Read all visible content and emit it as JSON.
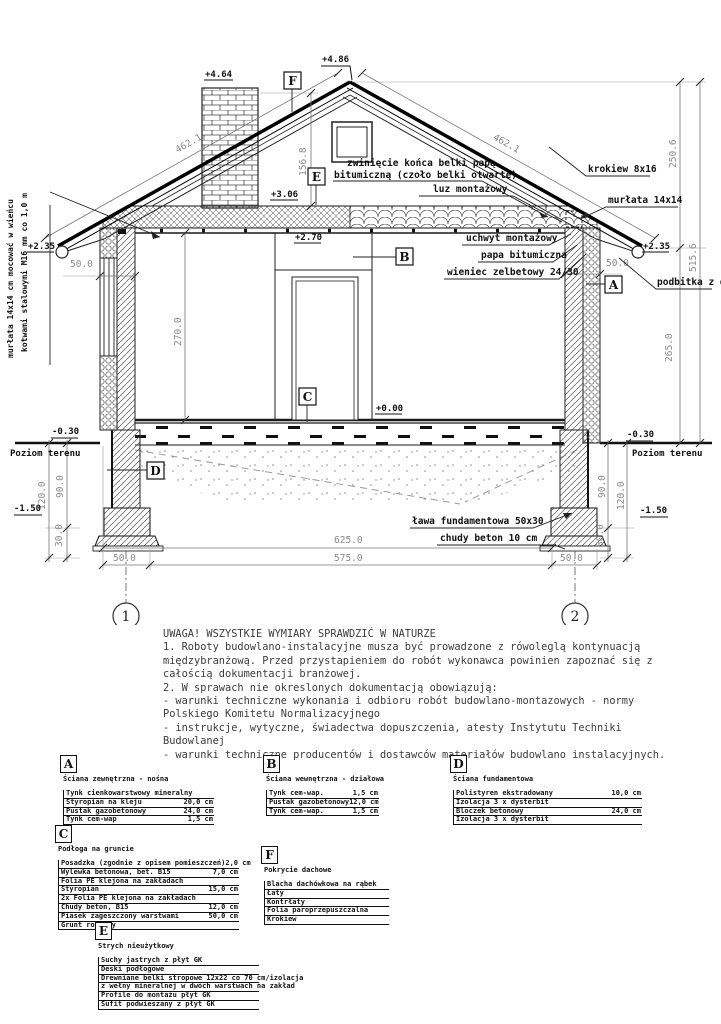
{
  "drawing": {
    "levels": {
      "chimney_top": "+4.64",
      "ridge": "+4.86",
      "attic_floor": "+3.06",
      "ceiling": "+2.70",
      "eave_left": "+2.35",
      "eave_right": "+2.35",
      "floor": "+0.00",
      "ground_left": "-0.30",
      "ground_right": "-0.30",
      "foundation_left": "-1.50",
      "foundation_right": "-1.50"
    },
    "dims": {
      "roof_left": "462.1",
      "roof_right": "462.1",
      "attic_height": "156.8",
      "right_upper": "250.6",
      "right_total": "515.6",
      "right_lower": "265.0",
      "room_height": "270.0",
      "wall_left": "50.0",
      "wall_right": "50.0",
      "found_left_90": "90.0",
      "found_left_120": "120.0",
      "found_left_30": "30.0",
      "found_right_90": "90.0",
      "found_right_120": "120.0",
      "found_right_30": "30.0",
      "total_width": "625.0",
      "inner_width": "575.0",
      "foot_left": "50.0",
      "foot_right": "50.0"
    },
    "labels": {
      "ground_left": "Poziom terenu",
      "ground_right": "Poziom terenu",
      "anchor_line1": "kotwami stalowymi M16 mm co 1,0 m",
      "anchor_line2": "murłata 14x14 cm mocować w wieńcu",
      "beam_wrap_1": "zwinięcie końca belki papą",
      "beam_wrap_2": "bitumiczną (czoło belki otwarte)",
      "luz": "luz montażowy",
      "krokiew": "krokiew 8x16",
      "murlata": "murłata 14x14",
      "uchwyt": "uchwyt montażowy",
      "papa": "papa bitumiczna",
      "wieniec": "wieniec zelbetowy 24/30",
      "podbitka": "podbitka z desek",
      "lawa": "ława fundamentowa 50x30",
      "chudy": "chudy beton 10 cm"
    },
    "markers": {
      "a": "A",
      "b": "B",
      "c": "C",
      "d": "D",
      "e": "E",
      "f": "F",
      "axis1": "1",
      "axis2": "2"
    }
  },
  "notes": {
    "lines": [
      "UWAGA! WSZYSTKIE WYMIARY SPRAWDZIĆ W NATURZE",
      "1. Roboty budowlano-instalacyjne musza być prowadzone z rówoleglą kontynuacją",
      "międzybranżową. Przed przystapieniem do robót wykonawca powinien zapoznać się z",
      "całością dokumentacji branżowej.",
      "2. W sprawach nie okreslonych dokumentacją obowiązują:",
      "- warunki techniczne wykonania i odbioru robót budowlano-montazowych - normy",
      "Polskiego Komitetu Normalizacyjnego",
      "- instrukcje, wytyczne, świadectwa dopuszczenia, atesty Instytutu Techniki",
      "Budowlanej",
      "- warunki techniczne producentów i dostawców materiałów budowlano instalacyjnych."
    ]
  },
  "legend": {
    "a": {
      "letter": "A",
      "title": "Ściana zewnętrzna - nośna",
      "rows": [
        {
          "n": "Tynk cienkowarstwowy mineralny",
          "v": ""
        },
        {
          "n": "Styropian na kleju",
          "v": "20,0 cm"
        },
        {
          "n": "Pustak gazobetonowy",
          "v": "24,0 cm"
        },
        {
          "n": "Tynk cem-wap",
          "v": "1,5 cm"
        }
      ]
    },
    "b": {
      "letter": "B",
      "title": "Ściana wewnętrzna - działowa",
      "rows": [
        {
          "n": "Tynk cem-wap.",
          "v": "1,5 cm"
        },
        {
          "n": "Pustak gazobetonowy",
          "v": "12,0 cm"
        },
        {
          "n": "Tynk cem-wap.",
          "v": "1,5 cm"
        }
      ]
    },
    "c": {
      "letter": "C",
      "title": "Podłoga na gruncie",
      "rows": [
        {
          "n": "Posadzka (zgodnie z opisem pomieszczeń)",
          "v": "2,0 cm"
        },
        {
          "n": "Wylewka betonowa, bet. B15",
          "v": "7,0 cm"
        },
        {
          "n": "Folia PE klejona na zakładach",
          "v": ""
        },
        {
          "n": "Styropian",
          "v": "15,0 cm"
        },
        {
          "n": "2x Folia PE klejona na zakładach",
          "v": ""
        },
        {
          "n": "Chudy beton, B15",
          "v": "12,0 cm"
        },
        {
          "n": "Piasek zageszczony warstwami",
          "v": "50,0 cm"
        },
        {
          "n": "Grunt rodzimy",
          "v": ""
        }
      ]
    },
    "d": {
      "letter": "D",
      "title": "Ściana fundamentowa",
      "rows": [
        {
          "n": "Polistyren ekstradowany",
          "v": "10,0 cm"
        },
        {
          "n": "Izolacja 3 x dysterbit",
          "v": ""
        },
        {
          "n": "Bloczek betonowy",
          "v": "24,0 cm"
        },
        {
          "n": "Izolacja 3 x dysterbit",
          "v": ""
        }
      ]
    },
    "e": {
      "letter": "E",
      "title": "Strych nieużytkowy",
      "rows": [
        {
          "n": "Suchy jastrych z płyt GK",
          "v": ""
        },
        {
          "n": "Deski podłogowe",
          "v": ""
        },
        {
          "n": "Drewniane belki stropowe 12x22 co 70 cm/izolacja",
          "v": ""
        },
        {
          "n": "z wełny mineralnej w dwóch warstwach na zakład",
          "v": ""
        },
        {
          "n": "Profile do montażu płyt GK",
          "v": ""
        },
        {
          "n": "Sufit podwieszany z płyt GK",
          "v": ""
        }
      ]
    },
    "f": {
      "letter": "F",
      "title": "Pokrycie dachowe",
      "rows": [
        {
          "n": "Blacha dachówkowa na rąbek",
          "v": ""
        },
        {
          "n": "Łaty",
          "v": ""
        },
        {
          "n": "Kontrłaty",
          "v": ""
        },
        {
          "n": "Folia paroprzepuszczalna",
          "v": ""
        },
        {
          "n": "Krokiew",
          "v": ""
        }
      ]
    }
  }
}
